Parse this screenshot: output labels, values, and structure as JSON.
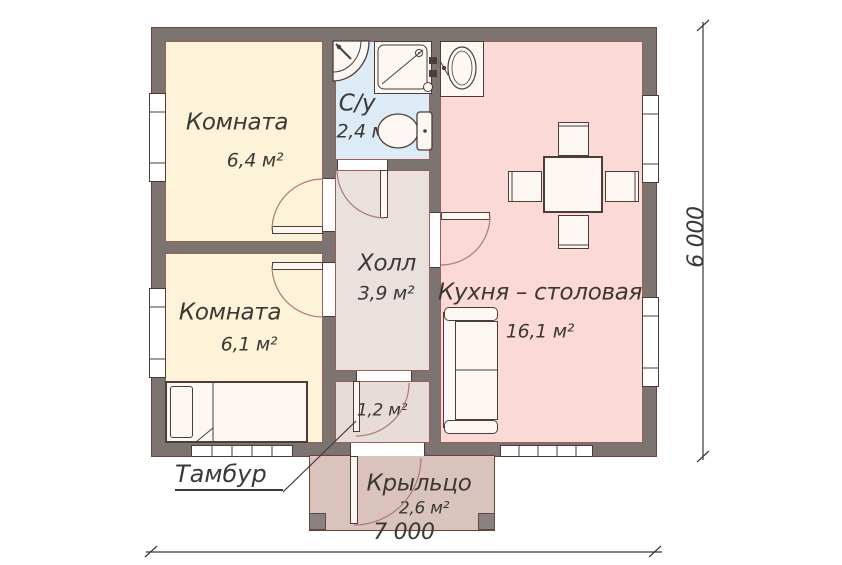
{
  "plan": {
    "rooms": {
      "room1": {
        "name": "Комната",
        "area": "6,4 м²"
      },
      "bathroom": {
        "name": "С/у",
        "area": "2,4 м"
      },
      "room2": {
        "name": "Комната",
        "area": "6,1 м²"
      },
      "hall": {
        "name": "Холл",
        "area": "3,9 м²"
      },
      "kitchen": {
        "name": "Кухня – столовая",
        "area": "16,1 м²"
      },
      "tambour": {
        "name": "Тамбур",
        "area": "1,2 м²"
      },
      "porch": {
        "name": "Крыльцо",
        "area": "2,6 м²"
      }
    },
    "dimensions": {
      "width": "7 000",
      "height": "6 000"
    },
    "colors": {
      "wall": "#7b7471",
      "bedroom_fill": "#fcf3d8",
      "bathroom_fill": "#dcebf5",
      "kitchen_fill": "#fbd9d7",
      "hall_fill": "#eae0de",
      "tambour_fill": "#e7dcda",
      "porch_fill": "#d9c3bc",
      "furniture_outline": "#4c3d37",
      "door_arc": "#ab7a74",
      "text": "#3b3836"
    }
  }
}
